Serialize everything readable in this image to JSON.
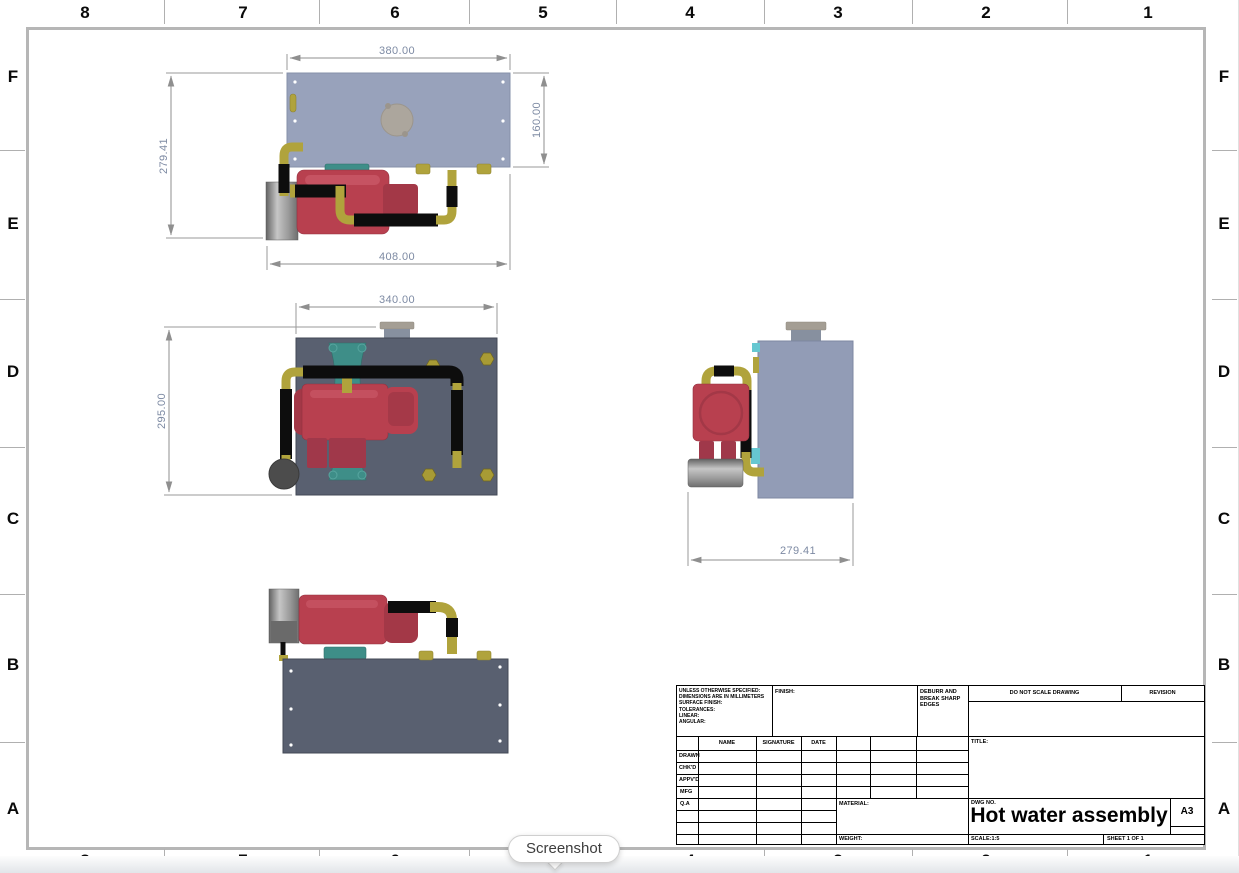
{
  "sheet": {
    "border_columns": [
      "8",
      "7",
      "6",
      "5",
      "4",
      "3",
      "2",
      "1"
    ],
    "border_rows": [
      "F",
      "E",
      "D",
      "C",
      "B",
      "A"
    ]
  },
  "tooltip": {
    "label": "Screenshot"
  },
  "views": {
    "top_view": {
      "dim_width": "380.00",
      "dim_height": "160.00",
      "dim_overall_height": "279.41",
      "dim_overall_width": "408.00"
    },
    "front_view": {
      "dim_width": "340.00",
      "dim_height": "295.00"
    },
    "side_view": {
      "dim_depth": "279.41"
    }
  },
  "title_block": {
    "tolerance_note": "UNLESS OTHERWISE SPECIFIED:\nDIMENSIONS ARE IN MILLIMETERS\nSURFACE FINISH:\nTOLERANCES:\n   LINEAR:\n   ANGULAR:",
    "finish_label": "FINISH:",
    "deburr_note": "DEBURR AND\nBREAK SHARP\nEDGES",
    "do_not_scale": "DO NOT SCALE DRAWING",
    "revision_label": "REVISION",
    "col_name": "NAME",
    "col_signature": "SIGNATURE",
    "col_date": "DATE",
    "row_drawn": "DRAWN",
    "row_chkd": "CHK'D",
    "row_appvd": "APPV'D",
    "row_mfg": "MFG",
    "row_qa": "Q.A",
    "title_label": "TITLE:",
    "material_label": "MATERIAL:",
    "weight_label": "WEIGHT:",
    "dwg_no_label": "DWG NO.",
    "drawing_title": "Hot water assembly",
    "paper_size": "A3",
    "scale_label": "SCALE:1:5",
    "sheet_label": "SHEET 1 OF 1"
  },
  "colors": {
    "tank_light": "#98a2bb",
    "plate_dark": "#596070",
    "pump_red": "#b8404f",
    "pipe_yellow": "#b0a33c",
    "hose_black": "#0d0d0d",
    "bracket_teal": "#3e8e88",
    "cylinder_gray": "#9a9a9a",
    "cap_tan": "#aca69d",
    "dimension_text": "#7d8aa3",
    "sheet_border": "#b6b6b6"
  }
}
